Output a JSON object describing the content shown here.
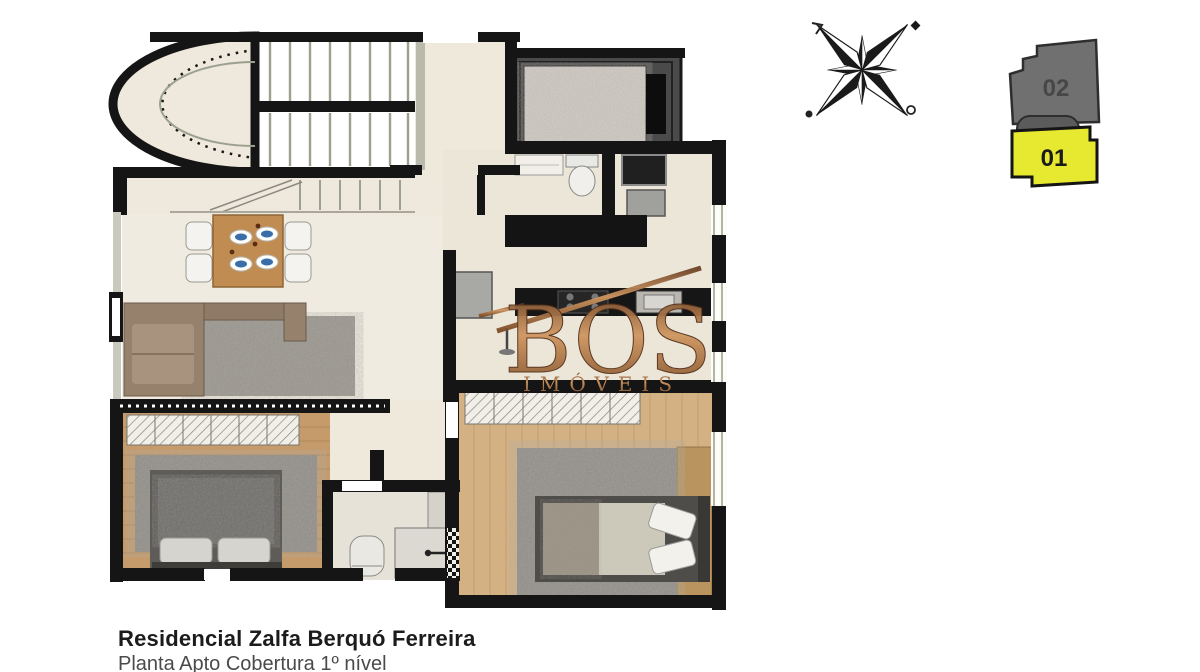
{
  "caption": {
    "line1": "Residencial Zalfa Berquó Ferreira",
    "line2": "Planta Apto Cobertura 1º nível"
  },
  "watermark": {
    "brand": "BOS",
    "subtitle": "IMÓVEIS",
    "color": "#9a6337"
  },
  "unit_selector": {
    "units": [
      {
        "label": "02",
        "color": "#707070",
        "text_color": "#474747",
        "highlighted": false
      },
      {
        "label": "01",
        "color": "#e6e930",
        "text_color": "#1b1b1b",
        "highlighted": true
      }
    ]
  }
}
